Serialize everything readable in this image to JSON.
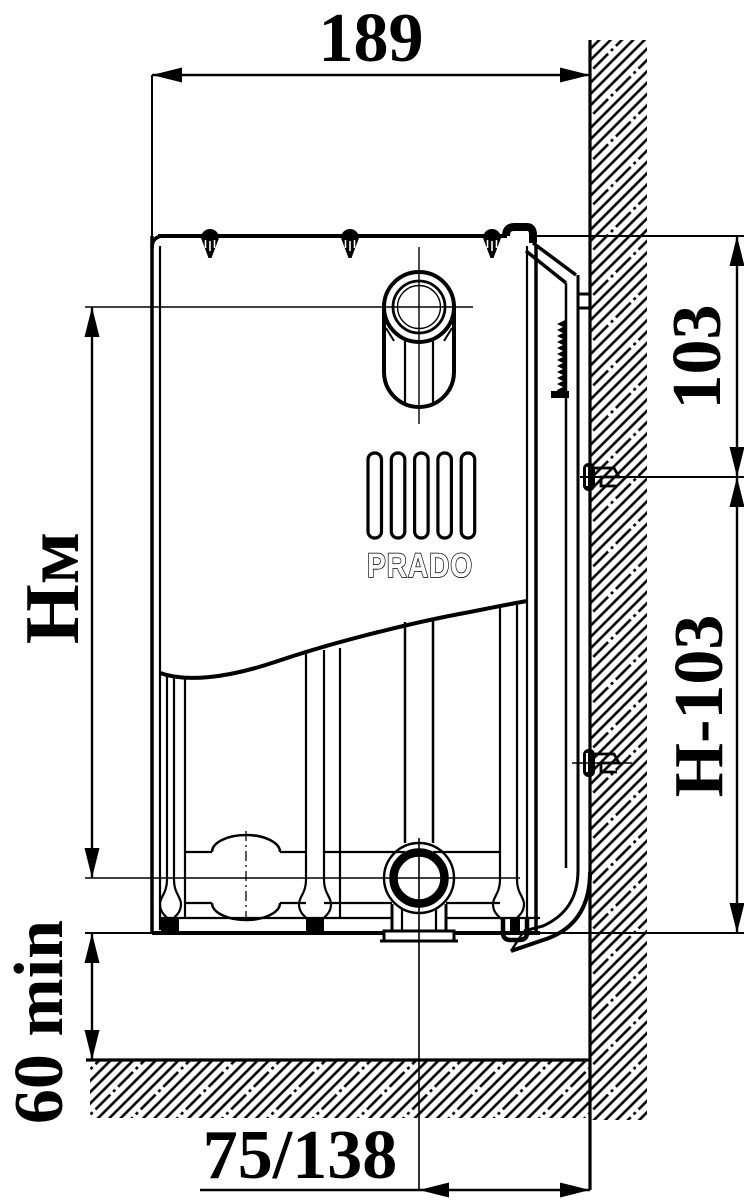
{
  "brand": {
    "logo_text": "PRADO"
  },
  "dimensions": {
    "depth_width": "189",
    "top_connection_offset": "103",
    "bottom_connection_offset": "H-103",
    "mounting_height_main": "Н",
    "mounting_height_sub": "м",
    "floor_clearance_min": "60 min",
    "pipe_wall_offset": "75/138"
  },
  "colors": {
    "line": "#000000",
    "background": "#ffffff"
  }
}
